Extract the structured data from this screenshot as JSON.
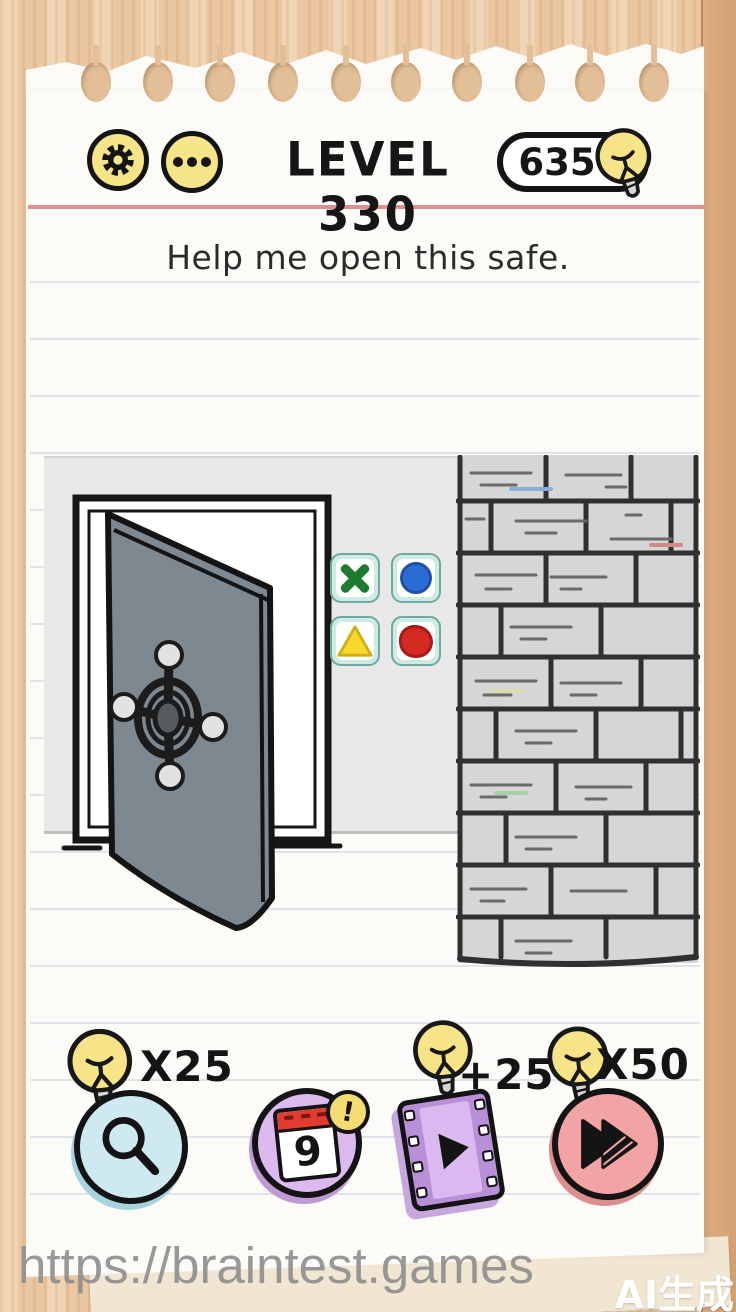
{
  "header": {
    "level_label": "LEVEL 330",
    "bulb_count": "635",
    "icons": {
      "settings": "gear-icon",
      "more": "ellipsis-icon",
      "currency": "lightbulb-icon"
    }
  },
  "question": "Help me open this safe.",
  "scene": {
    "elements": [
      "open-safe-door",
      "safe-dial",
      "brick-wall",
      "code-button-grid"
    ],
    "safe_buttons": [
      {
        "id": "green-cross",
        "shape": "cross",
        "color": "#1e7a2e"
      },
      {
        "id": "blue-circle",
        "shape": "circle",
        "color": "#2a6cd6"
      },
      {
        "id": "yellow-triangle",
        "shape": "triangle",
        "color": "#f6d92c"
      },
      {
        "id": "red-circle",
        "shape": "circle",
        "color": "#d52a22"
      }
    ]
  },
  "powerups": {
    "hint_label": "X25",
    "calendar_day": "9",
    "calendar_badge": "!",
    "video_label": "+25",
    "skip_label": "X50",
    "icons": {
      "hint": "magnifier-icon",
      "calendar": "calendar-icon",
      "video": "film-strip-icon",
      "skip": "fast-forward-icon",
      "cost": "lightbulb-icon"
    }
  },
  "watermark": {
    "url": "https://braintest.games",
    "ai_tag": "AI生成"
  },
  "colors": {
    "accent_yellow": "#f6e488",
    "paper": "#fcfbf7",
    "wood": "#eac7a0",
    "red_line": "#db9191",
    "hint_button": "#cfe9f1",
    "calendar_button": "#dcb9ee",
    "video_button": "#b98fd8",
    "skip_button": "#f2a3a3",
    "safe_door": "#7d8890",
    "brick": "#d6d6d6"
  }
}
